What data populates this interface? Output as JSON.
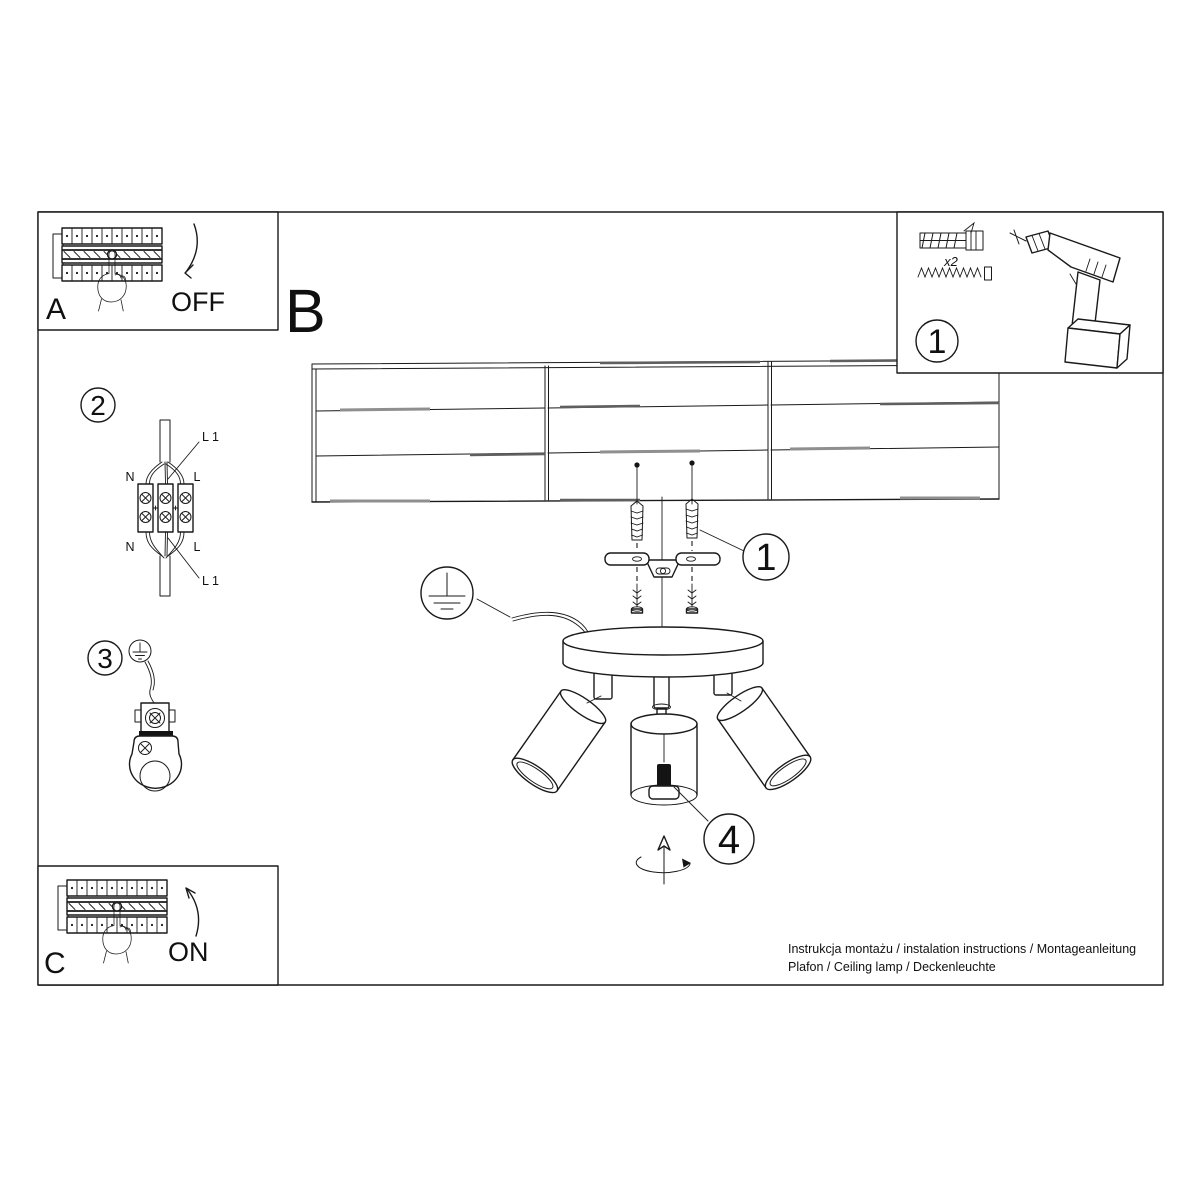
{
  "colors": {
    "line": "#1a1a1a",
    "background": "#ffffff",
    "plank_shade_light": "#8f8f8f",
    "plank_shade_dark": "#5f5f5f"
  },
  "labels": {
    "step_a": {
      "letter": "A",
      "action": "OFF"
    },
    "section_b": {
      "letter": "B"
    },
    "step_c": {
      "letter": "C",
      "action": "ON"
    },
    "tools_box": {
      "number": "1",
      "screw_quantity": "x2"
    },
    "wiring_step": {
      "number": "2",
      "wire_top_left": "N",
      "wire_top_right": "L",
      "wire_line_top": "L 1",
      "wire_bottom_left": "N",
      "wire_bottom_right": "L",
      "wire_line_bottom": "L 1"
    },
    "ground_step": {
      "number": "3"
    },
    "mount_step": {
      "number": "1"
    },
    "bulb_step": {
      "number": "4"
    }
  },
  "footer": {
    "line1": "Instrukcja montażu / instalation instructions / Montageanleitung",
    "line2": "Plafon / Ceiling lamp / Deckenleuchte"
  }
}
